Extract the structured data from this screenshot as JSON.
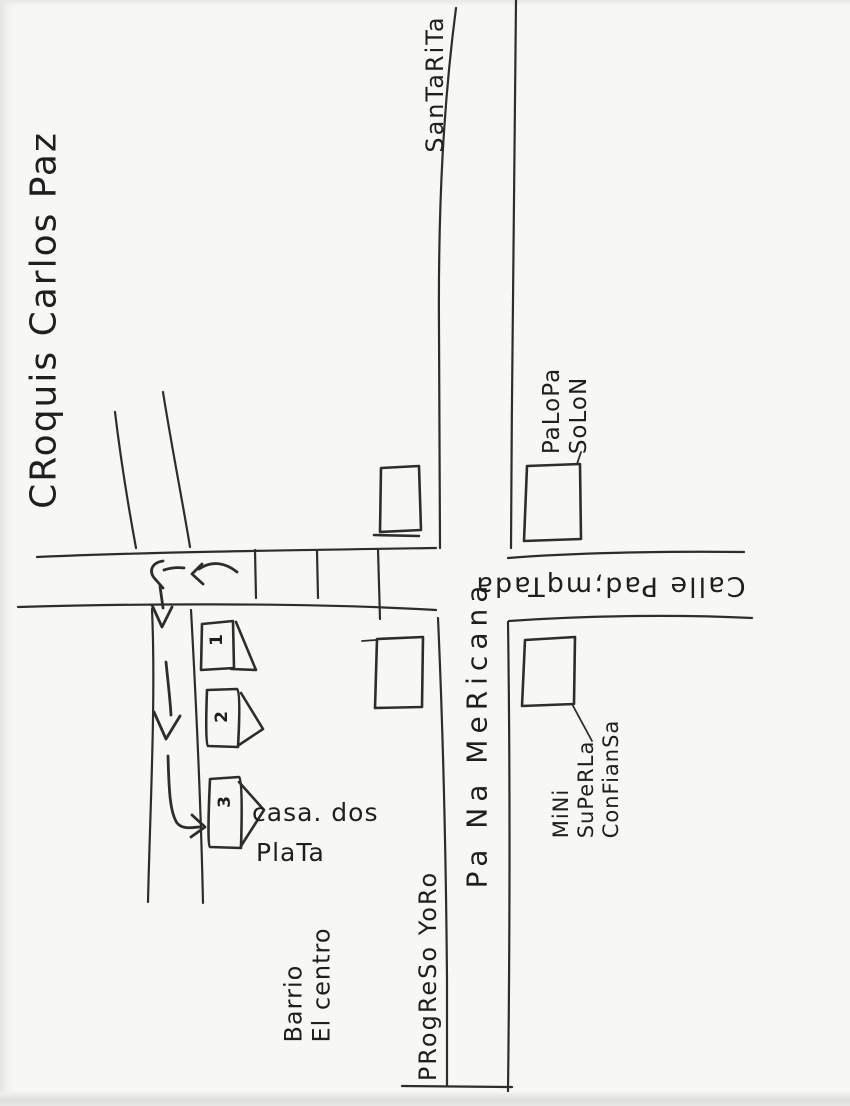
{
  "map": {
    "title": "CRoquis Carlos Paz",
    "streets": {
      "top_destination": "SanTaRiTa",
      "main_vertical": "Pa Na MeRicana",
      "cross_street": "Calle Pad;mqTada",
      "bottom_destination": "PRogReSo YoRo"
    },
    "places": {
      "palopa": [
        "PaLoPa",
        "SoLoN"
      ],
      "mini_super": [
        "MiNi",
        "SuPeRLa",
        "ConFianSa"
      ],
      "casa": [
        "casa. dos",
        "PlaTa"
      ],
      "barrio": [
        "Barrio",
        "El centro"
      ]
    },
    "houses": [
      "1",
      "2",
      "3"
    ],
    "colors": {
      "ink": "#2d2d2d",
      "paper": "#f7f7f5"
    }
  }
}
